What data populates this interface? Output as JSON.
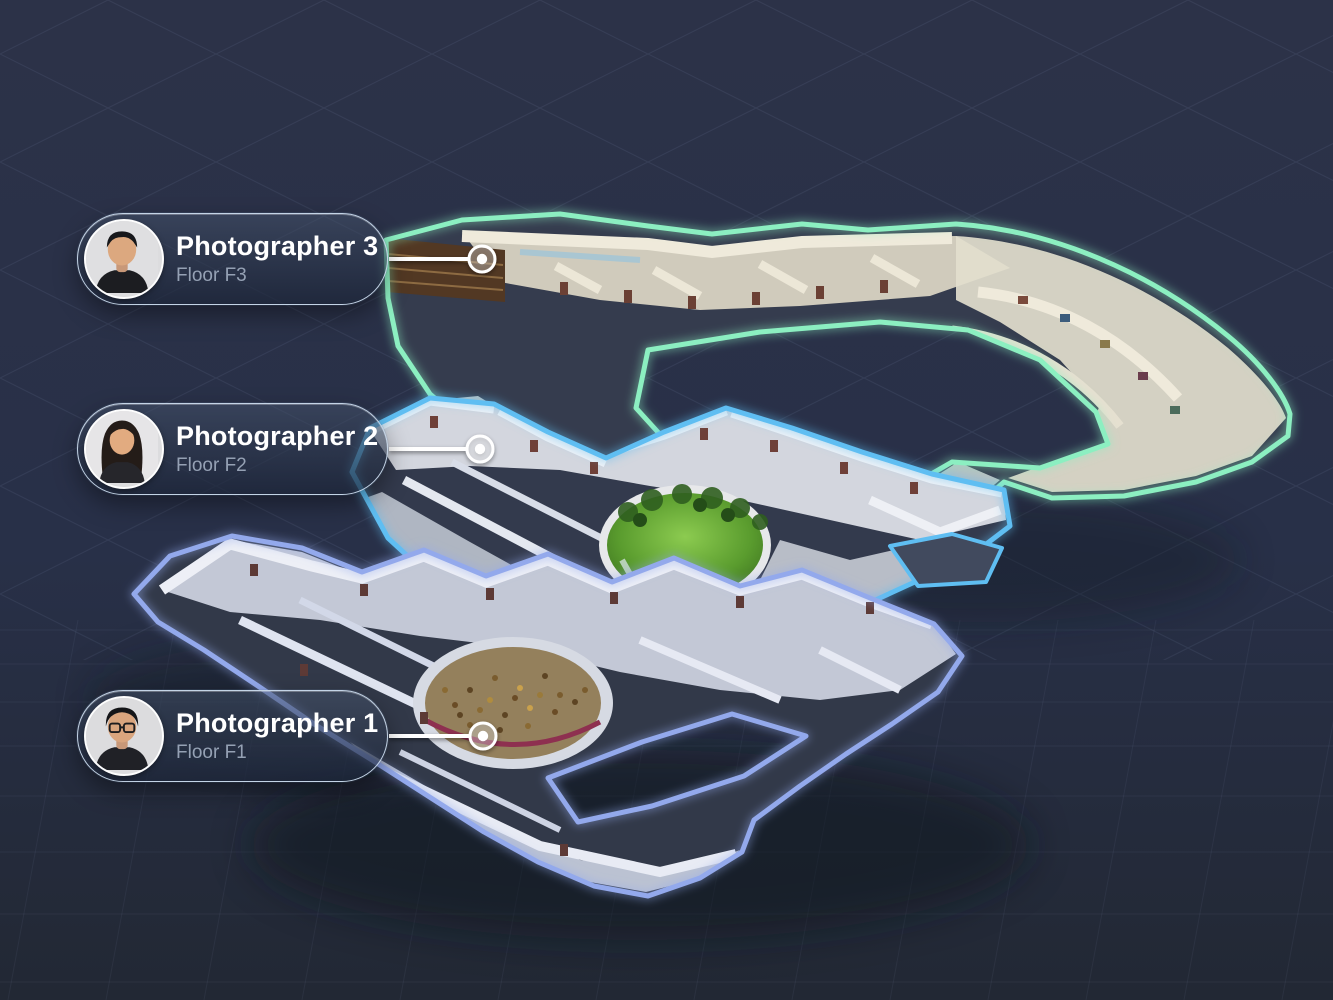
{
  "theme": {
    "background_top": "#2c3248",
    "background_mid": "#283048",
    "background_bottom": "#222834",
    "pill_border": "#c4d4e6",
    "pill_title_color": "#ffffff",
    "pill_subtitle_color": "#95a1b4",
    "marker_color": "#ffffff"
  },
  "floors": [
    {
      "id": "F3",
      "level": 3,
      "outline_color": "#8cefc1"
    },
    {
      "id": "F2",
      "level": 2,
      "outline_color": "#5fbef2"
    },
    {
      "id": "F1",
      "level": 1,
      "outline_color": "#93a9ec"
    }
  ],
  "photographers": [
    {
      "name": "Photographer 3",
      "floor_label": "Floor F3",
      "floor_id": "F3",
      "avatar_icon": "man-short-hair-avatar"
    },
    {
      "name": "Photographer 2",
      "floor_label": "Floor F2",
      "floor_id": "F2",
      "avatar_icon": "woman-long-hair-avatar"
    },
    {
      "name": "Photographer 1",
      "floor_label": "Floor F1",
      "floor_id": "F1",
      "avatar_icon": "man-glasses-avatar"
    }
  ]
}
